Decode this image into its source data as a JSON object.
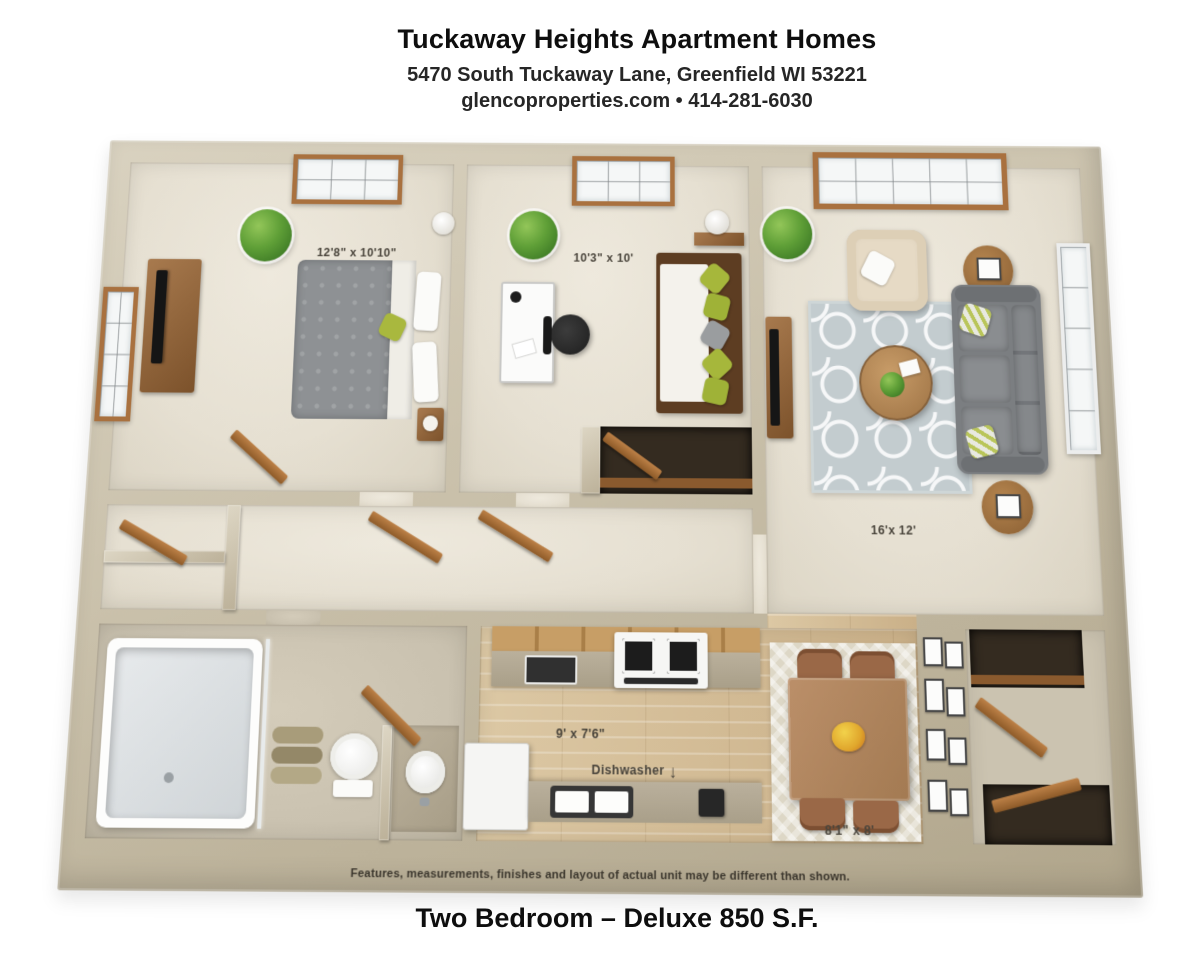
{
  "header": {
    "title": "Tuckaway Heights Apartment Homes",
    "address": "5470 South Tuckaway Lane, Greenfield WI 53221",
    "contact": "glencoproperties.com • 414-281-6030"
  },
  "floorplan": {
    "labels": {
      "bedroom1": "12'8\" x 10'10\"",
      "bedroom2": "10'3\" x 10'",
      "living_room": "16'x 12'",
      "kitchen": "9' x 7'6\"",
      "dining": "8'1\" x 8'",
      "dishwasher": "Dishwasher",
      "dishwasher_arrow": "↓"
    },
    "disclaimer": "Features, measurements, finishes and layout of actual unit may be different than shown."
  },
  "footer": {
    "plan_name": "Two Bedroom – Deluxe 850 S.F."
  },
  "colors": {
    "wall": "#c6bda7",
    "carpet": "#e8e3d7",
    "wood_floor": "#d3bd97",
    "trim_wood": "#a9713f",
    "sofa": "#7b7e81",
    "rug": "#c3cccf",
    "label_text": "#49443b"
  }
}
